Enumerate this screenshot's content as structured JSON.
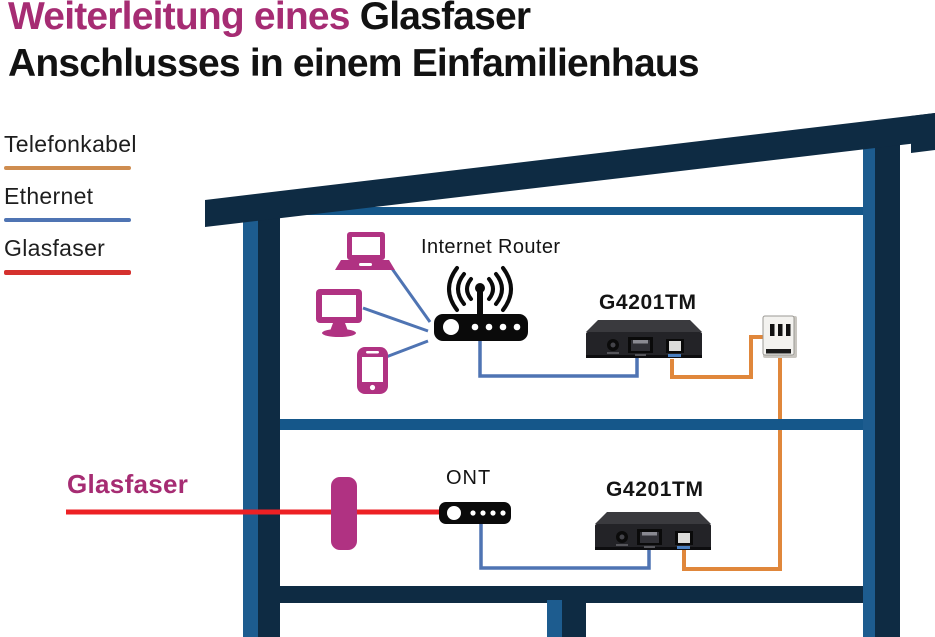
{
  "title": {
    "line1_highlight": "Weiterleitung eines",
    "line1_rest": "Glasfaser",
    "line2": "Anschlusses in einem Einfamilienhaus"
  },
  "legend": {
    "items": [
      {
        "label": "Telefonkabel",
        "color": "#cf8d50"
      },
      {
        "label": "Ethernet",
        "color": "#4f74b3"
      },
      {
        "label": "Glasfaser",
        "color": "#d5312e"
      }
    ]
  },
  "diagram": {
    "upper_floor": {
      "router_label": "Internet Router",
      "extender_label": "G4201TM",
      "client_devices": [
        "laptop",
        "monitor",
        "smartphone"
      ],
      "wall_socket": "tae-telephone-socket"
    },
    "lower_floor": {
      "fiber_label": "Glasfaser",
      "ont_label": "ONT",
      "extender_label": "G4201TM"
    },
    "colors": {
      "telefonkabel_line": "#e0873b",
      "ethernet_line": "#4f74b3",
      "glasfaser_line": "#ed2024",
      "house_dark_navy": "#0e2b43",
      "house_mid_blue": "#15578a",
      "house_light_blue": "#1d5c8f",
      "accent_magenta": "#b03282",
      "title_magenta": "#a62c73"
    }
  }
}
